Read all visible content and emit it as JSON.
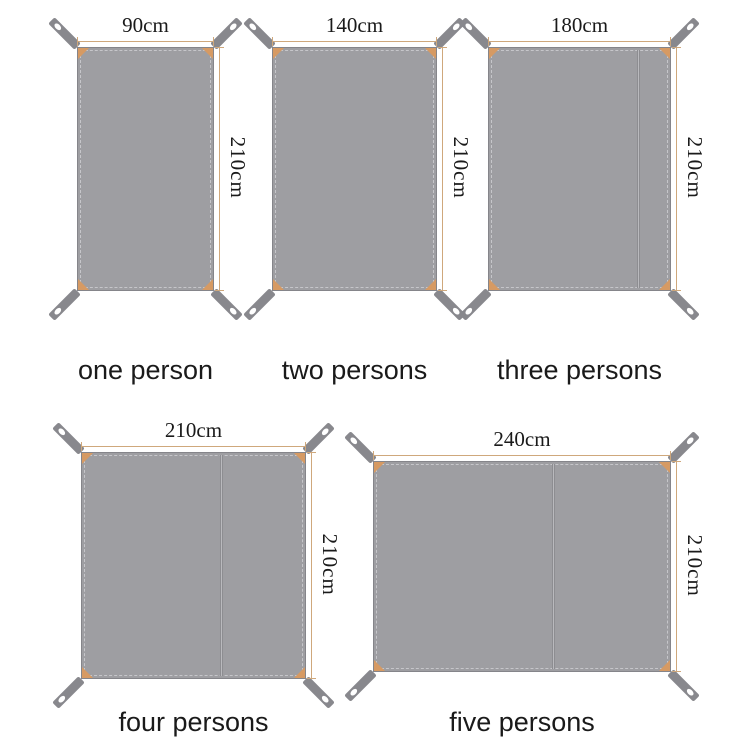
{
  "palette": {
    "tarp_fill": "#9e9ea2",
    "tarp_border": "#85858a",
    "stitch": "#c6c6ca",
    "seam": "#8d8d91",
    "strap": "#88888d",
    "grommet": "#ffffff",
    "corner_patch": "#d69a63",
    "dimension_line": "#cfa87c",
    "text": "#1a1a1a"
  },
  "diagram": {
    "description": "Tent ground sheet size comparison, five sizes",
    "items": [
      {
        "label": "one person",
        "width_label": "90cm",
        "height_label": "210cm",
        "width_cm": 90,
        "height_cm": 210,
        "panel_seam": false
      },
      {
        "label": "two persons",
        "width_label": "140cm",
        "height_label": "210cm",
        "width_cm": 140,
        "height_cm": 210,
        "panel_seam": false
      },
      {
        "label": "three persons",
        "width_label": "180cm",
        "height_label": "210cm",
        "width_cm": 180,
        "height_cm": 210,
        "panel_seam": true
      },
      {
        "label": "four persons",
        "width_label": "210cm",
        "height_label": "210cm",
        "width_cm": 210,
        "height_cm": 210,
        "panel_seam": true
      },
      {
        "label": "five persons",
        "width_label": "240cm",
        "height_label": "210cm",
        "width_cm": 240,
        "height_cm": 210,
        "panel_seam": true
      }
    ]
  }
}
